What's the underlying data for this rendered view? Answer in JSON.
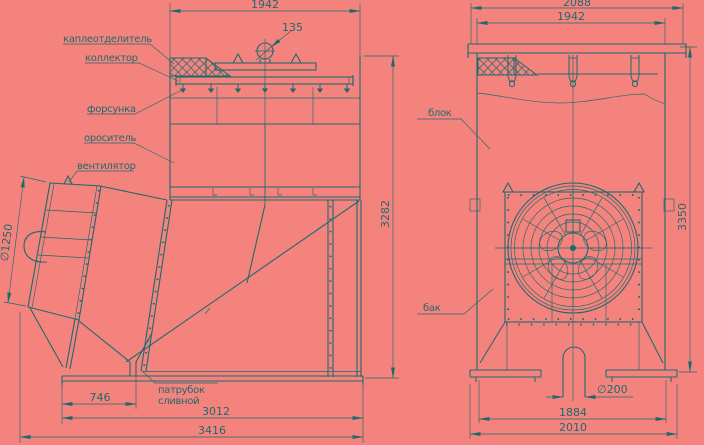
{
  "colors": {
    "background": "#f5837d",
    "ink": "#1d6a6e"
  },
  "labels": {
    "droplet_separator": "каплеотделитель",
    "collector": "коллектор",
    "nozzle": "форсунка",
    "sprinkler": "ороситель",
    "fan": "вентилятор",
    "block": "блок",
    "tank": "бак",
    "drain_pipe_line1": "патрубок",
    "drain_pipe_line2": "сливной"
  },
  "dimensions": {
    "left_view": {
      "top_width": "1942",
      "pipe_diameter": "135",
      "height": "3282",
      "fan_diameter": "∅1250",
      "drain_offset": "746",
      "base_width": "3012",
      "overall_width": "3416"
    },
    "right_view": {
      "cap_width": "2088",
      "body_width": "1942",
      "height": "3350",
      "drain_diameter": "∅200",
      "support_span": "1884",
      "base_width": "2010"
    }
  }
}
